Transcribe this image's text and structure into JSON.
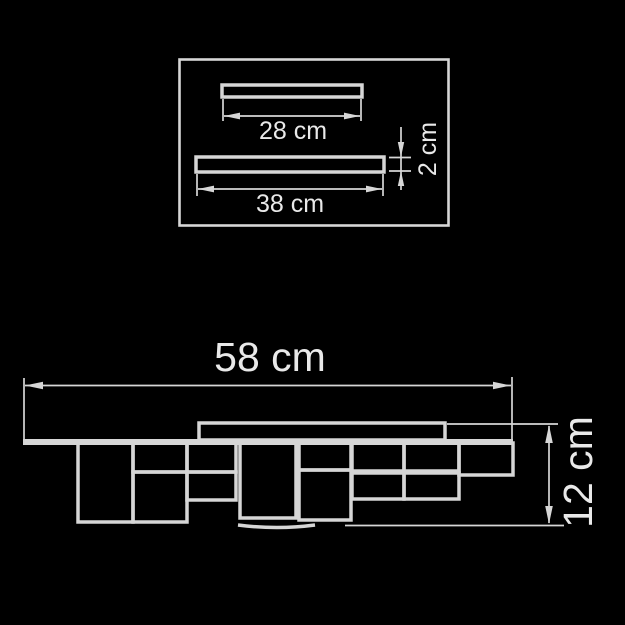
{
  "colors": {
    "background": "#000000",
    "line": "#d6d6d6",
    "text": "#e9e9e9"
  },
  "diagram_type": "ceiling-light dimension drawing",
  "top_view": {
    "small_bar_width_label": "28 cm",
    "large_bar_width_label": "38 cm",
    "bar_thickness_label": "2 cm"
  },
  "front_view": {
    "overall_width_label": "58 cm",
    "overall_height_label": "12 cm"
  }
}
